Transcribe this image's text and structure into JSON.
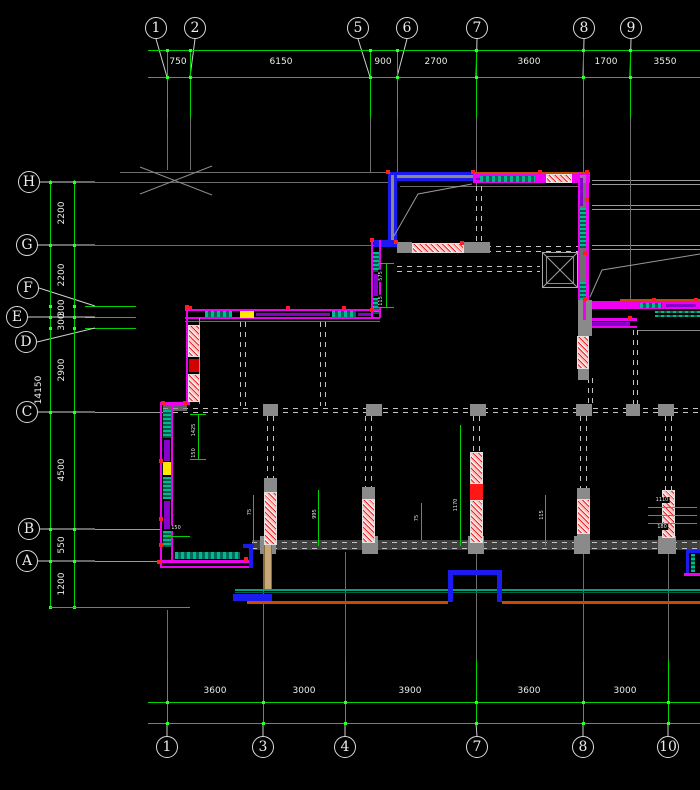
{
  "drawing": {
    "type": "architectural-structural floor plan (CAD)",
    "colors": {
      "background": "#000000",
      "dimension_green": "#00d200",
      "grid_gray": "#6e6e6e",
      "wall_magenta": "#f000f0",
      "wall_blue": "#1b1bf0",
      "hatch_red_pink": "#e02828",
      "hatch_teal": "#00b894",
      "accent_yellow": "#ffe800",
      "accent_orange": "#c84b00",
      "accent_tan": "#c8a878",
      "text_white": "#ececec"
    },
    "grid_top": {
      "line1_y": 50,
      "line2_y": 77,
      "x_start": 148,
      "x_end": 700,
      "green_drop_to_y": 118,
      "bubbles": [
        {
          "label": "1",
          "bx": 156,
          "gx": 167
        },
        {
          "label": "2",
          "bx": 195,
          "gx": 190
        },
        {
          "label": "5",
          "bx": 358,
          "gx": 370
        },
        {
          "label": "6",
          "bx": 407,
          "gx": 397
        },
        {
          "label": "7",
          "bx": 477,
          "gx": 476
        },
        {
          "label": "8",
          "bx": 584,
          "gx": 583
        },
        {
          "label": "9",
          "bx": 631,
          "gx": 630
        }
      ],
      "dims": [
        {
          "text": "750",
          "x": 178
        },
        {
          "text": "6150",
          "x": 281
        },
        {
          "text": "900",
          "x": 383
        },
        {
          "text": "2700",
          "x": 436
        },
        {
          "text": "3600",
          "x": 529
        },
        {
          "text": "1700",
          "x": 606
        },
        {
          "text": "3550",
          "x": 665
        }
      ]
    },
    "grid_bottom": {
      "line1_y": 702,
      "line2_y": 723,
      "x_start": 148,
      "x_end": 700,
      "green_rise_from_y": 660,
      "bubbles": [
        {
          "label": "1",
          "bx": 167,
          "gx": 167
        },
        {
          "label": "3",
          "bx": 263,
          "gx": 263
        },
        {
          "label": "4",
          "bx": 345,
          "gx": 345
        },
        {
          "label": "7",
          "bx": 477,
          "gx": 476
        },
        {
          "label": "8",
          "bx": 583,
          "gx": 583
        },
        {
          "label": "10",
          "bx": 668,
          "gx": 668
        }
      ],
      "dims": [
        {
          "text": "3600",
          "x": 215
        },
        {
          "text": "3000",
          "x": 304
        },
        {
          "text": "3900",
          "x": 410
        },
        {
          "text": "3600",
          "x": 529
        },
        {
          "text": "3000",
          "x": 625
        }
      ]
    },
    "grid_left": {
      "line1_x": 50,
      "line2_x": 74,
      "y_start": 180,
      "y_end": 607,
      "bubbles": [
        {
          "label": "H",
          "bx": 29,
          "by": 182,
          "gy": 182
        },
        {
          "label": "G",
          "bx": 27,
          "by": 245,
          "gy": 245
        },
        {
          "label": "F",
          "bx": 28,
          "by": 288,
          "gy": 306
        },
        {
          "label": "E",
          "bx": 17,
          "by": 317,
          "gy": 317
        },
        {
          "label": "D",
          "bx": 26,
          "by": 342,
          "gy": 328
        },
        {
          "label": "C",
          "bx": 27,
          "by": 412,
          "gy": 412
        },
        {
          "label": "B",
          "bx": 29,
          "by": 529,
          "gy": 529
        },
        {
          "label": "A",
          "bx": 27,
          "by": 561,
          "gy": 561
        }
      ],
      "extra_marker_y": 607,
      "dims": [
        {
          "text": "2200",
          "y": 213
        },
        {
          "text": "2200",
          "y": 275
        },
        {
          "text": "300",
          "y": 308
        },
        {
          "text": "300",
          "y": 322
        },
        {
          "text": "2900",
          "y": 370
        },
        {
          "text": "4500",
          "y": 470
        },
        {
          "text": "550",
          "y": 545
        },
        {
          "text": "1200",
          "y": 584
        }
      ],
      "overall_dim": {
        "text": "14150",
        "x": 39,
        "y": 390
      }
    },
    "inner_annotations": {
      "labels": [
        {
          "text": "575",
          "x": 381,
          "y": 276,
          "rot": 1
        },
        {
          "text": "115",
          "x": 381,
          "y": 301,
          "rot": 1
        },
        {
          "text": "1425",
          "x": 194,
          "y": 430,
          "rot": 1
        },
        {
          "text": "150",
          "x": 194,
          "y": 453,
          "rot": 1
        },
        {
          "text": "75",
          "x": 250,
          "y": 512,
          "rot": 1
        },
        {
          "text": "995",
          "x": 315,
          "y": 514,
          "rot": 1
        },
        {
          "text": "1170",
          "x": 456,
          "y": 505,
          "rot": 1
        },
        {
          "text": "115",
          "x": 542,
          "y": 515,
          "rot": 1
        },
        {
          "text": "75",
          "x": 417,
          "y": 518,
          "rot": 1
        },
        {
          "text": "1110",
          "x": 662,
          "y": 500,
          "rot": 0
        },
        {
          "text": "180",
          "x": 662,
          "y": 527,
          "rot": 0
        },
        {
          "text": "150",
          "x": 176,
          "y": 528,
          "rot": 0
        }
      ],
      "lines": [
        {
          "v": 1,
          "x": 386,
          "y1": 263,
          "y2": 307
        },
        {
          "v": 1,
          "x": 198,
          "y1": 414,
          "y2": 459
        },
        {
          "v": 1,
          "x": 253,
          "y1": 495,
          "y2": 543
        },
        {
          "v": 1,
          "x": 318,
          "y1": 490,
          "y2": 546
        },
        {
          "v": 1,
          "x": 460,
          "y1": 425,
          "y2": 546
        },
        {
          "v": 1,
          "x": 545,
          "y1": 495,
          "y2": 546
        },
        {
          "v": 1,
          "x": 421,
          "y1": 503,
          "y2": 540
        },
        {
          "v": 0,
          "y": 507,
          "x1": 648,
          "x2": 697
        },
        {
          "v": 0,
          "y": 515,
          "x1": 648,
          "x2": 697
        },
        {
          "v": 0,
          "y": 523,
          "x1": 648,
          "x2": 697
        },
        {
          "v": 0,
          "y": 536,
          "x1": 168,
          "x2": 190
        },
        {
          "v": 0,
          "y": 263,
          "x1": 378,
          "x2": 394
        },
        {
          "v": 0,
          "y": 307,
          "x1": 378,
          "x2": 394
        },
        {
          "v": 0,
          "y": 414,
          "x1": 190,
          "x2": 206
        },
        {
          "v": 0,
          "y": 459,
          "x1": 190,
          "x2": 206
        }
      ]
    },
    "grips": [
      [
        386,
        170
      ],
      [
        471,
        170
      ],
      [
        538,
        170
      ],
      [
        585,
        170
      ],
      [
        585,
        197
      ],
      [
        583,
        251
      ],
      [
        583,
        297
      ],
      [
        628,
        316
      ],
      [
        652,
        298
      ],
      [
        694,
        298
      ],
      [
        370,
        238
      ],
      [
        370,
        308
      ],
      [
        185,
        305
      ],
      [
        286,
        306
      ],
      [
        342,
        306
      ],
      [
        161,
        401
      ],
      [
        183,
        401
      ],
      [
        159,
        459
      ],
      [
        159,
        517
      ],
      [
        159,
        543
      ],
      [
        157,
        560
      ],
      [
        244,
        557
      ],
      [
        394,
        240
      ],
      [
        460,
        241
      ],
      [
        188,
        306
      ]
    ]
  }
}
